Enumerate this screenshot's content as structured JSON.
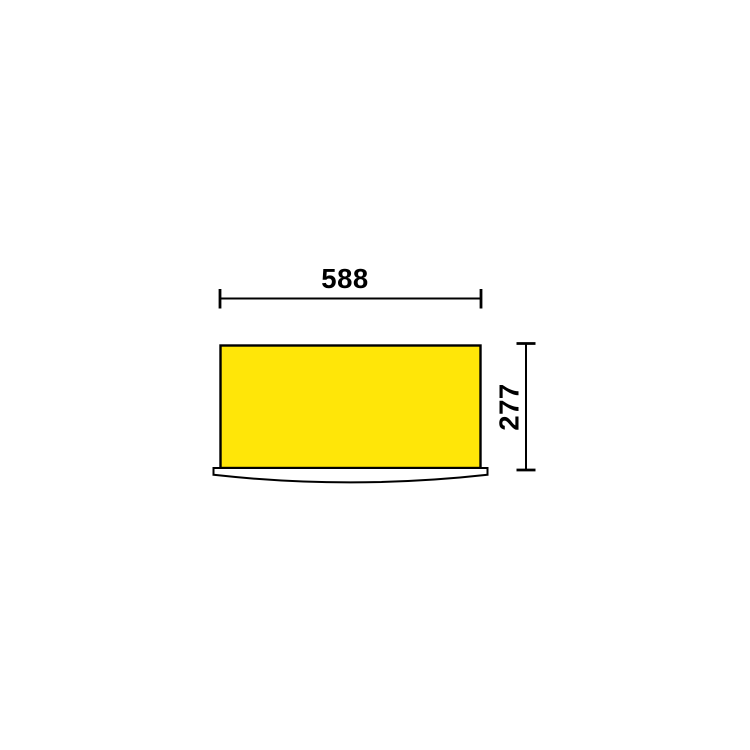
{
  "drawing": {
    "type": "technical-dimension-drawing",
    "subject": "cabinet-front-view",
    "dimensions": {
      "width_label": "588",
      "height_label": "277"
    }
  },
  "colors": {
    "cabinet_fill": "#FFE608",
    "outline": "#000000",
    "background": "#FFFFFF"
  }
}
